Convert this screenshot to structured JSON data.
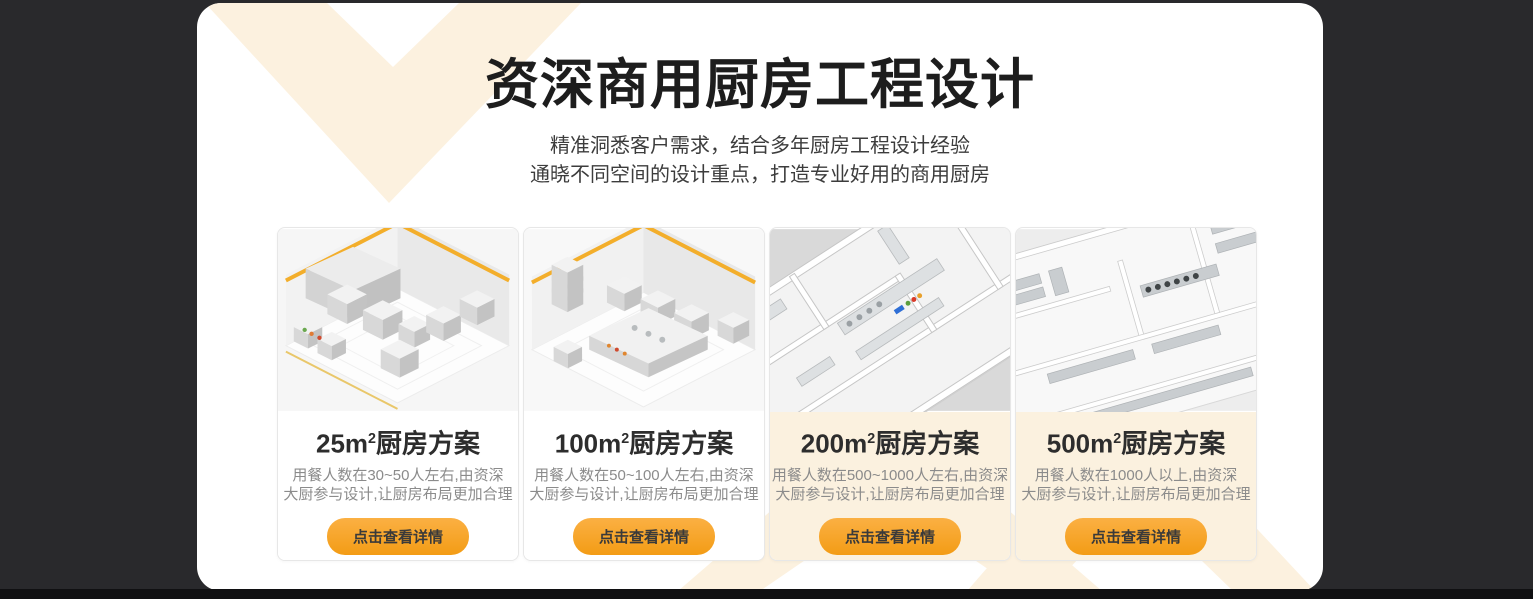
{
  "hero": {
    "title": "资深商用厨房工程设计",
    "subtitle_line1": "精准洞悉客户需求，结合多年厨房工程设计经验",
    "subtitle_line2": "通晓不同空间的设计重点，打造专业好用的商用厨房"
  },
  "cards": [
    {
      "size": "25m",
      "sup": "2",
      "name": "厨房方案",
      "desc_line1": "用餐人数在30~50人左右,由资深",
      "desc_line2": "大厨参与设计,让厨房布局更加合理",
      "button_label": "点击查看详情",
      "image_alt": "25-square-meter-kitchen-isometric-render"
    },
    {
      "size": "100m",
      "sup": "2",
      "name": "厨房方案",
      "desc_line1": "用餐人数在50~100人左右,由资深",
      "desc_line2": "大厨参与设计,让厨房布局更加合理",
      "button_label": "点击查看详情",
      "image_alt": "100-square-meter-kitchen-isometric-render"
    },
    {
      "size": "200m",
      "sup": "2",
      "name": "厨房方案",
      "desc_line1": "用餐人数在500~1000人左右,由资深",
      "desc_line2": "大厨参与设计,让厨房布局更加合理",
      "button_label": "点击查看详情",
      "image_alt": "200-square-meter-kitchen-floorplan-render"
    },
    {
      "size": "500m",
      "sup": "2",
      "name": "厨房方案",
      "desc_line1": "用餐人数在1000人以上,由资深",
      "desc_line2": "大厨参与设计,让厨房布局更加合理",
      "button_label": "点击查看详情",
      "image_alt": "500-square-meter-kitchen-floorplan-render"
    }
  ],
  "colors": {
    "accent_orange": "#F6A42B",
    "decor_cream": "#FCF1DF",
    "page_background": "#29292C",
    "bottom_bar": "#101012"
  }
}
